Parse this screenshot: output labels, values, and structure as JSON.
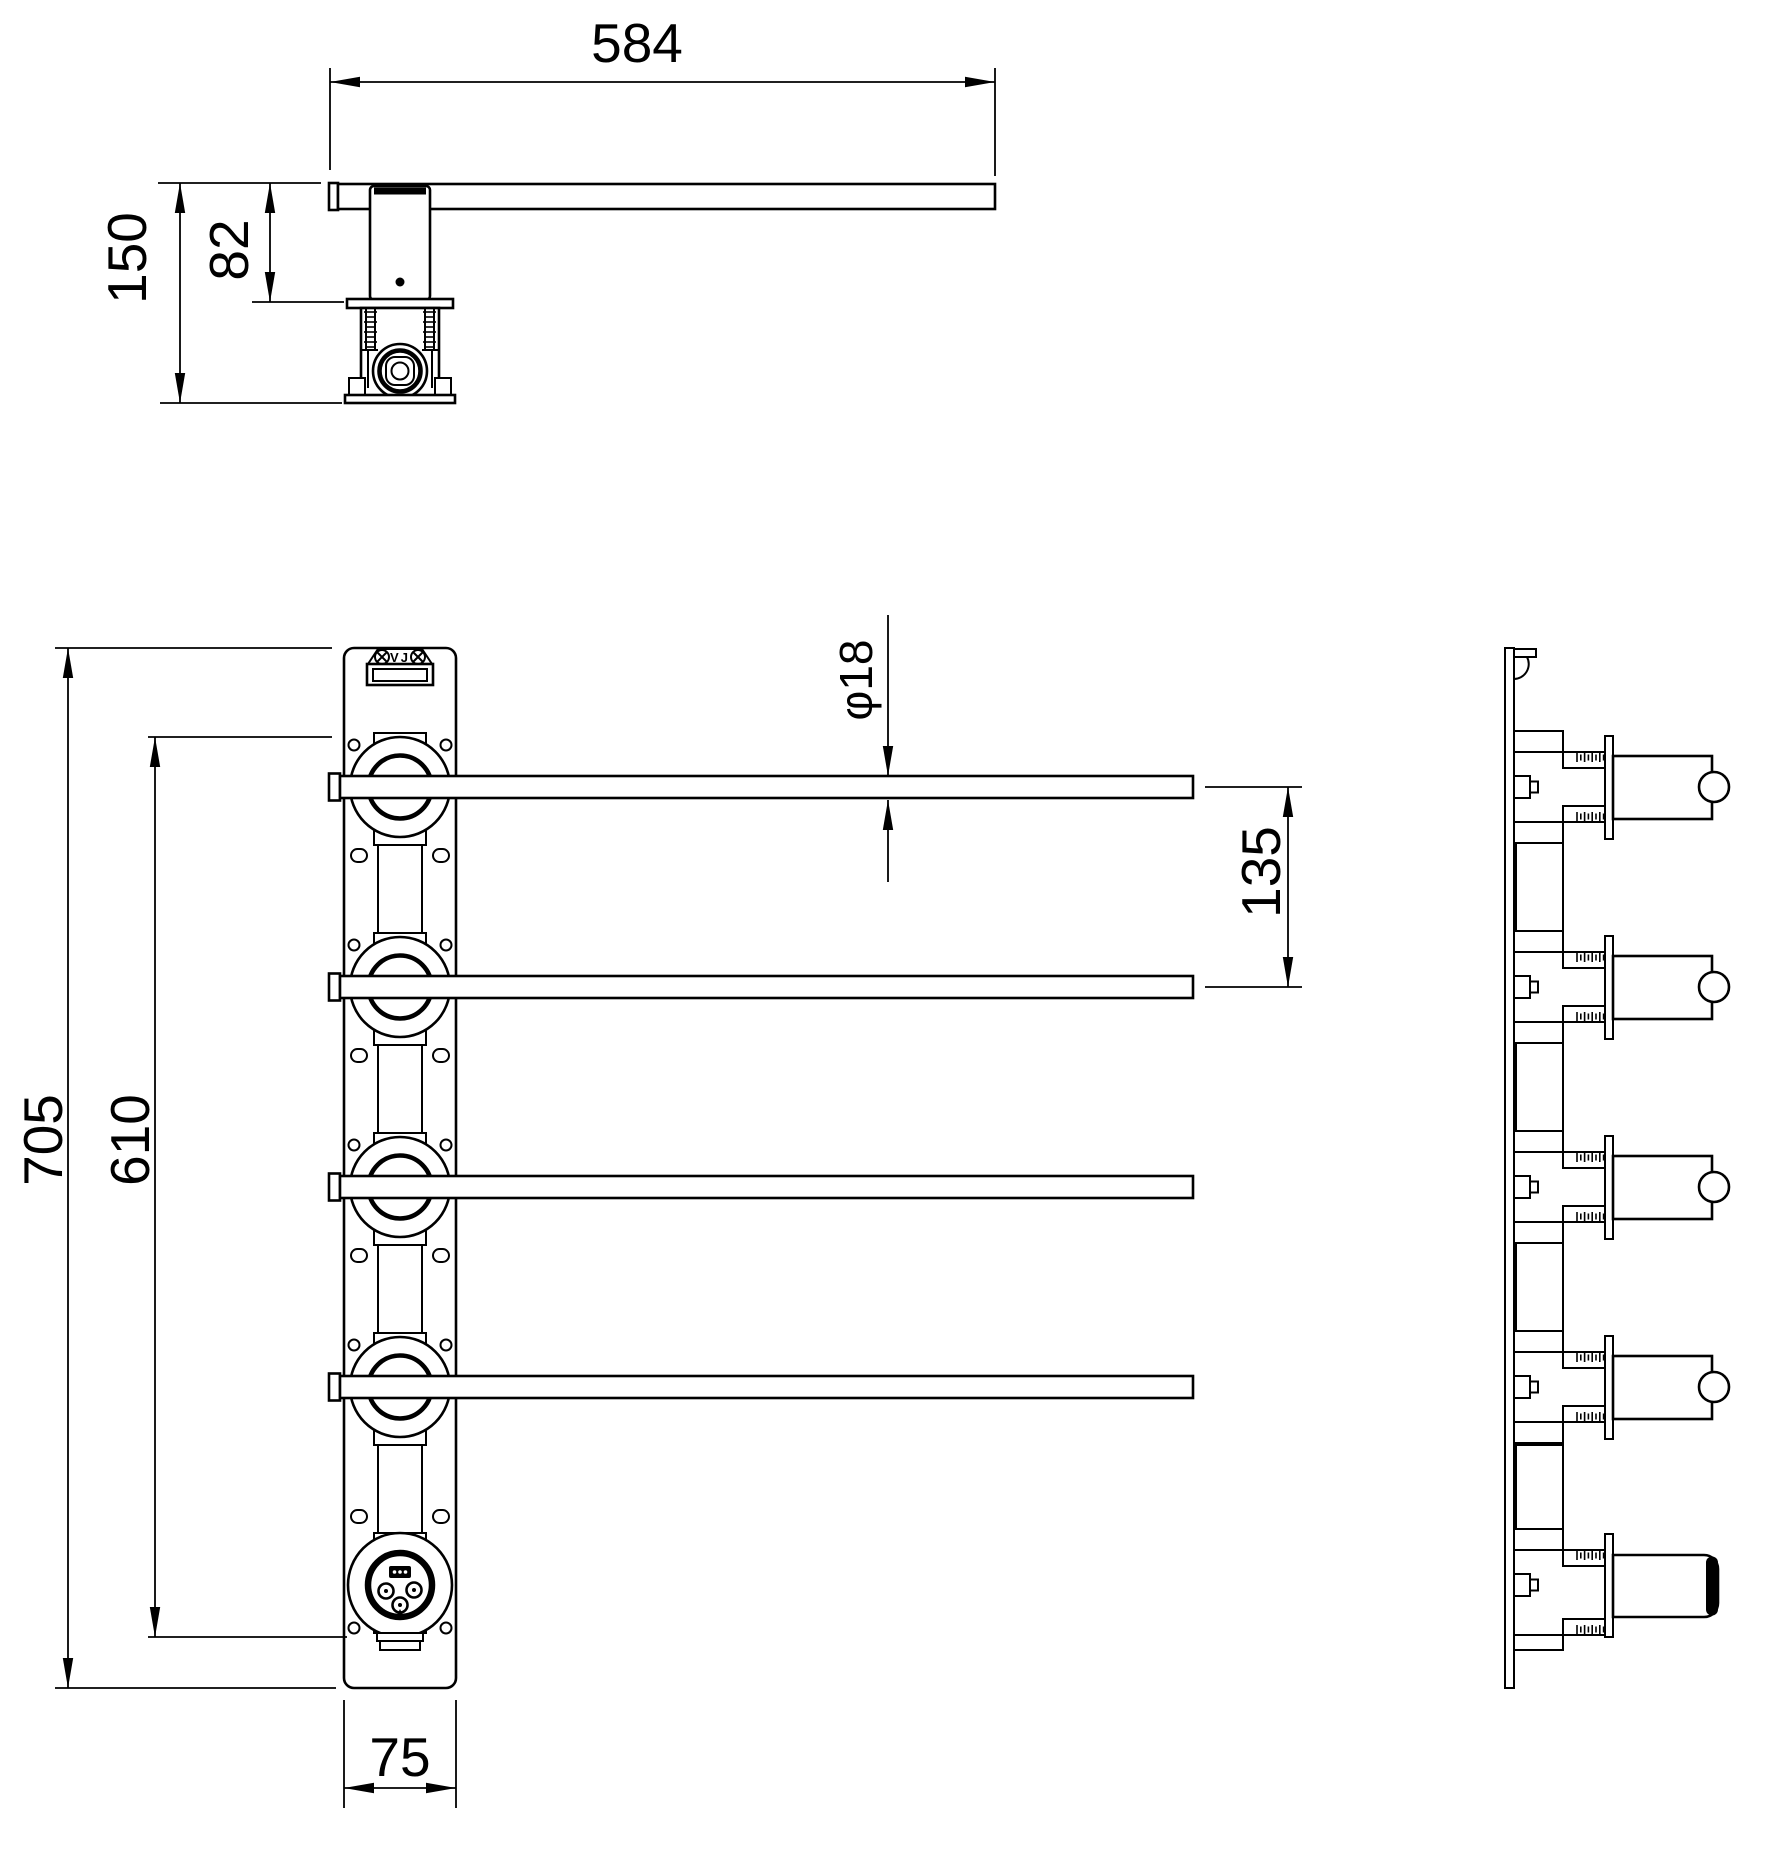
{
  "drawing": {
    "background": "#ffffff",
    "line_color": "#000000",
    "brand_plate_text": "VJ"
  },
  "dimensions": {
    "top_view": {
      "bar_length": "584",
      "bar_to_flange_depth": "82",
      "total_depth": "150"
    },
    "front_view": {
      "overall_height": "705",
      "mount_span": "610",
      "panel_width": "75",
      "bar_pitch": "135",
      "bar_diameter": "φ18"
    }
  }
}
